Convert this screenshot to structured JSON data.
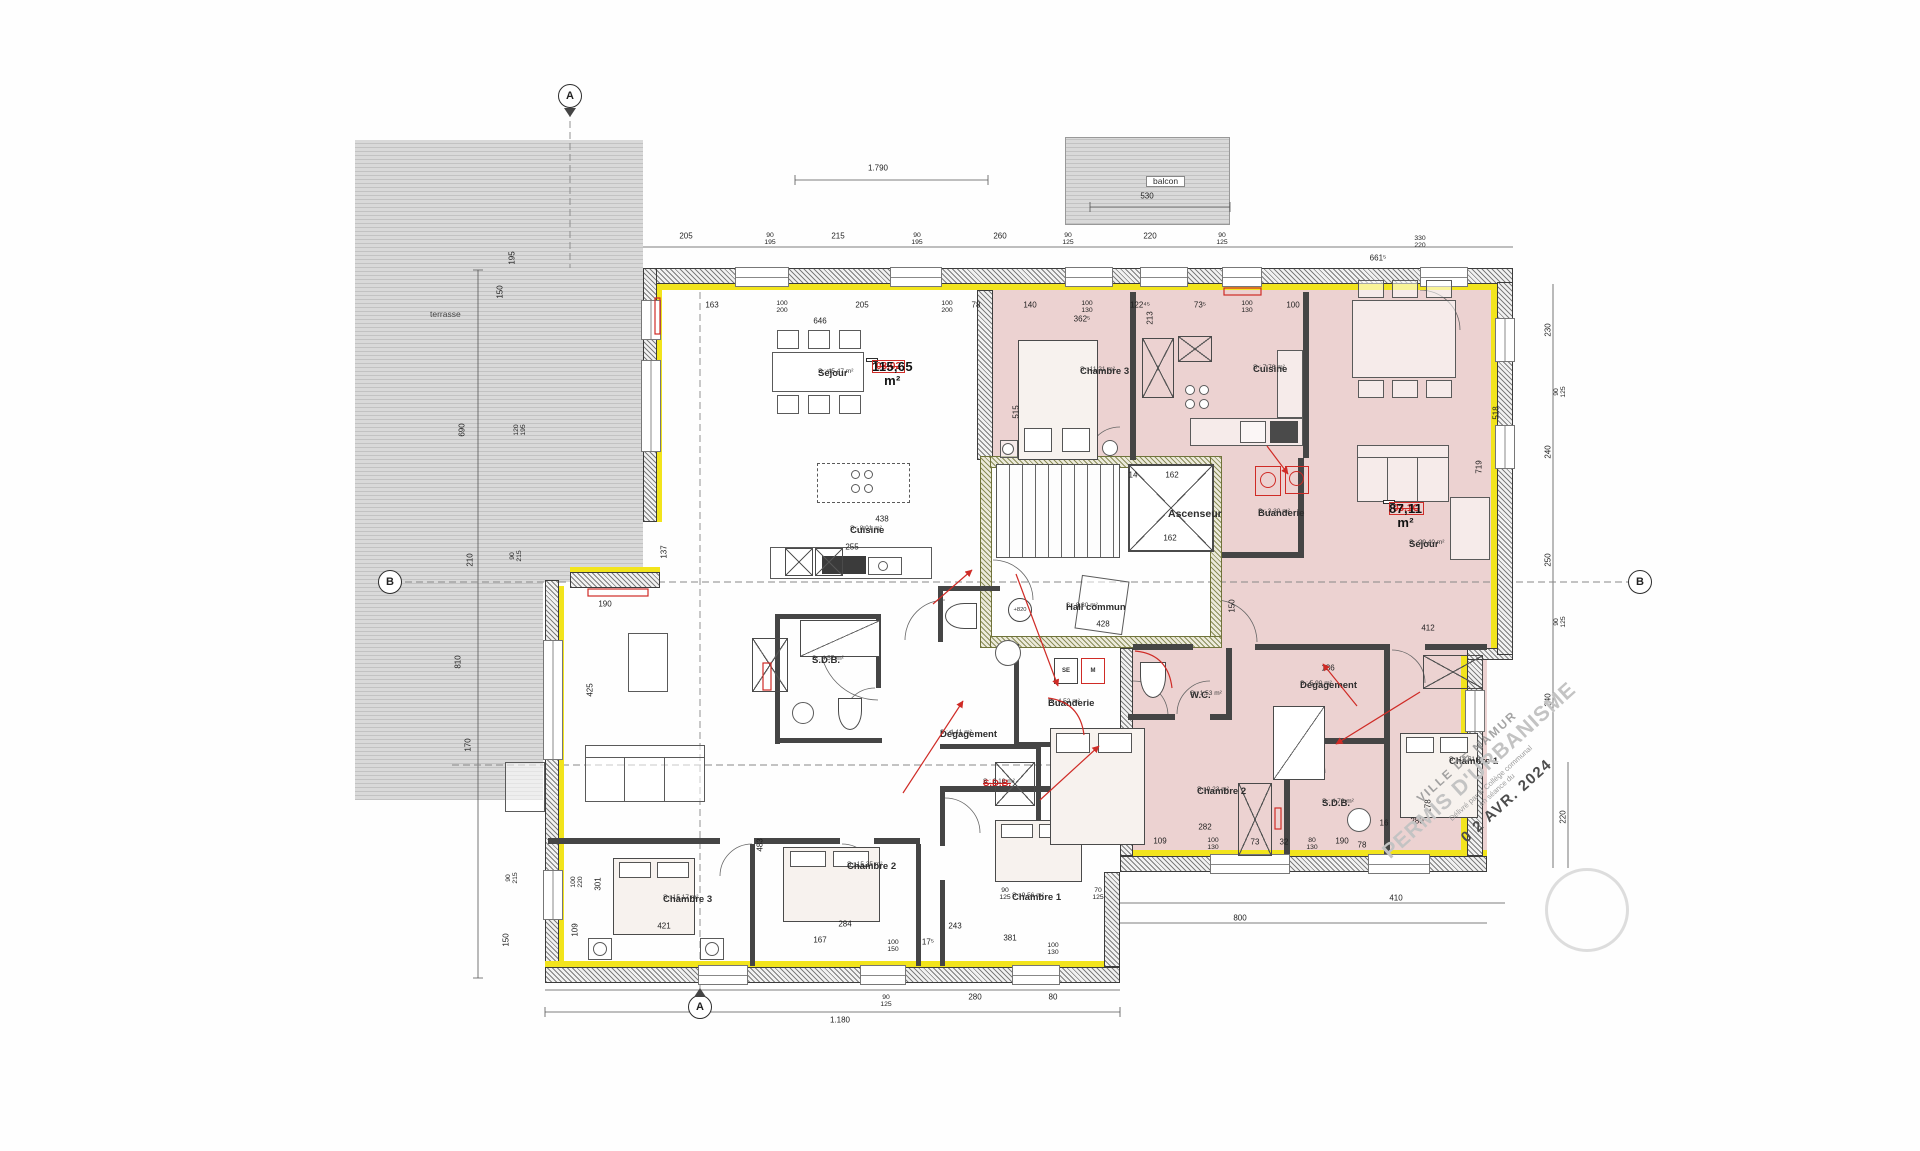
{
  "title": "Plan d'étage - permis d'urbanisme",
  "palette": {
    "pink": "#ecd2d1",
    "insulation_yellow": "#f2e41c",
    "wall_gray": "#7d7d7d",
    "revision_red": "#cf2b26",
    "hatch_gray": "#d9d9d9"
  },
  "outdoor": {
    "terrasse": "terrasse",
    "balcon": "balcon"
  },
  "apartments": {
    "apt_left": {
      "code": "03.02",
      "area": "115,65 m²"
    },
    "apt_right": {
      "code": "03.1C",
      "area": "87,11 m²"
    }
  },
  "core": {
    "ascenseur": "Ascenseur",
    "hall_name": "Hall commun",
    "hall_area": "S : 8,30 m²",
    "level": "+820"
  },
  "laundry": {
    "se": "SE",
    "m": "M"
  },
  "markers": {
    "a": "A",
    "b": "B"
  },
  "stamp": {
    "line1": "VILLE DE NAMUR",
    "line2": "PERMIS D'URBANISME",
    "line3": "Délivré par le Collège communal",
    "line4": "en séance du",
    "date": "0 2 AVR. 2024"
  },
  "rooms": [
    {
      "id": "sejour-blanc",
      "name": "Séjour",
      "area": "S : 45,47 m²",
      "x": 818,
      "y": 369,
      "cls": ""
    },
    {
      "id": "cuisine-blanc",
      "name": "Cuisine",
      "area": "S : 8,01 m²",
      "x": 850,
      "y": 526,
      "cls": ""
    },
    {
      "id": "sdb-blanc",
      "name": "S.D.B.",
      "area": "S : 4,57 m²",
      "x": 812,
      "y": 656,
      "cls": ""
    },
    {
      "id": "degagement-blanc",
      "name": "Dégagement",
      "area": "S : 4,41 m²",
      "x": 940,
      "y": 730,
      "cls": ""
    },
    {
      "id": "buanderie-blanc",
      "name": "Buanderie",
      "area": "S : 4,52 m²",
      "x": 1048,
      "y": 699,
      "cls": ""
    },
    {
      "id": "sdb2-blanc",
      "name": "S.D.B.",
      "area": "S : 3,10 m²",
      "x": 983,
      "y": 779,
      "cls": "struck"
    },
    {
      "id": "chambre3-blanc",
      "name": "Chambre 3",
      "area": "S : 15,17 m²",
      "x": 663,
      "y": 895,
      "cls": ""
    },
    {
      "id": "chambre2-blanc",
      "name": "Chambre 2",
      "area": "S : 15,35 m²",
      "x": 847,
      "y": 862,
      "cls": ""
    },
    {
      "id": "chambre1-blanc",
      "name": "Chambre 1",
      "area": "S : 9,56 m²",
      "x": 1012,
      "y": 893,
      "cls": ""
    },
    {
      "id": "ascenseur",
      "name": "Ascenseur",
      "area": "",
      "x": 1168,
      "y": 509,
      "cls": "big"
    },
    {
      "id": "hall-commun",
      "name": "Hall commun",
      "area": "S : 8,30 m²",
      "x": 1066,
      "y": 603,
      "cls": ""
    },
    {
      "id": "chambre3-rose",
      "name": "Chambre 3",
      "area": "S : 11,21 m²",
      "x": 1080,
      "y": 367,
      "cls": ""
    },
    {
      "id": "cuisine-rose",
      "name": "Cuisine",
      "area": "S : 7,76 m²",
      "x": 1253,
      "y": 365,
      "cls": ""
    },
    {
      "id": "buanderie-rose",
      "name": "Buanderie",
      "area": "S : 3,30 m²",
      "x": 1258,
      "y": 509,
      "cls": ""
    },
    {
      "id": "sejour-rose",
      "name": "Séjour",
      "area": "S : 29,40 m²",
      "x": 1409,
      "y": 540,
      "cls": ""
    },
    {
      "id": "wc-rose",
      "name": "W.C.",
      "area": "S : 1,53 m²",
      "x": 1190,
      "y": 691,
      "cls": ""
    },
    {
      "id": "degagement-rose",
      "name": "Dégagement",
      "area": "S : 5,90 m²",
      "x": 1300,
      "y": 681,
      "cls": ""
    },
    {
      "id": "chambre2-rose",
      "name": "Chambre 2",
      "area": "S : 9,23 m²",
      "x": 1197,
      "y": 787,
      "cls": ""
    },
    {
      "id": "sdb-rose",
      "name": "S.D.B.",
      "area": "S : 4,76 m²",
      "x": 1322,
      "y": 799,
      "cls": ""
    },
    {
      "id": "chambre1-rose",
      "name": "Chambre 1",
      "area": "S : 13,51 m²",
      "x": 1449,
      "y": 757,
      "cls": ""
    },
    {
      "id": "terrasse",
      "name": "terrasse",
      "area": "",
      "x": 430,
      "y": 310,
      "cls": "out"
    },
    {
      "id": "balcon",
      "name": "balcon",
      "area": "",
      "x": 1146,
      "y": 176,
      "cls": "boxed"
    }
  ],
  "dims": [
    {
      "t": "1.790",
      "x": 878,
      "y": 168
    },
    {
      "t": "205",
      "x": 686,
      "y": 236
    },
    {
      "t": "90\n195",
      "x": 770,
      "y": 240,
      "s": 1
    },
    {
      "t": "215",
      "x": 838,
      "y": 236
    },
    {
      "t": "90\n195",
      "x": 917,
      "y": 240,
      "s": 1
    },
    {
      "t": "260",
      "x": 1000,
      "y": 236
    },
    {
      "t": "90\n125",
      "x": 1068,
      "y": 240,
      "s": 1
    },
    {
      "t": "220",
      "x": 1150,
      "y": 236
    },
    {
      "t": "90\n125",
      "x": 1222,
      "y": 240,
      "s": 1
    },
    {
      "t": "530",
      "x": 1147,
      "y": 196
    },
    {
      "t": "330\n220",
      "x": 1420,
      "y": 243,
      "s": 1
    },
    {
      "t": "661⁵",
      "x": 1378,
      "y": 258
    },
    {
      "t": "163",
      "x": 712,
      "y": 305
    },
    {
      "t": "100\n200",
      "x": 782,
      "y": 308,
      "s": 1
    },
    {
      "t": "205",
      "x": 862,
      "y": 305
    },
    {
      "t": "100\n200",
      "x": 947,
      "y": 308,
      "s": 1
    },
    {
      "t": "78",
      "x": 976,
      "y": 305
    },
    {
      "t": "646",
      "x": 820,
      "y": 321
    },
    {
      "t": "140",
      "x": 1030,
      "y": 305
    },
    {
      "t": "100\n130",
      "x": 1087,
      "y": 308,
      "s": 1
    },
    {
      "t": "122⁴⁵",
      "x": 1140,
      "y": 305
    },
    {
      "t": "362⁵",
      "x": 1082,
      "y": 319
    },
    {
      "t": "73⁵",
      "x": 1200,
      "y": 305
    },
    {
      "t": "100\n130",
      "x": 1247,
      "y": 308,
      "s": 1
    },
    {
      "t": "100",
      "x": 1293,
      "y": 305
    },
    {
      "t": "213",
      "x": 1150,
      "y": 318,
      "v": 1
    },
    {
      "t": "515",
      "x": 1016,
      "y": 412,
      "v": 1
    },
    {
      "t": "195",
      "x": 512,
      "y": 258,
      "v": 1
    },
    {
      "t": "150",
      "x": 500,
      "y": 292,
      "v": 1
    },
    {
      "t": "690",
      "x": 462,
      "y": 430,
      "v": 1
    },
    {
      "t": "120\n195",
      "x": 521,
      "y": 430,
      "v": 1,
      "s": 1
    },
    {
      "t": "210",
      "x": 470,
      "y": 560,
      "v": 1
    },
    {
      "t": "90\n215",
      "x": 517,
      "y": 556,
      "v": 1,
      "s": 1
    },
    {
      "t": "810",
      "x": 458,
      "y": 662,
      "v": 1
    },
    {
      "t": "170",
      "x": 468,
      "y": 745,
      "v": 1
    },
    {
      "t": "90\n215",
      "x": 513,
      "y": 878,
      "v": 1,
      "s": 1
    },
    {
      "t": "150",
      "x": 506,
      "y": 940,
      "v": 1
    },
    {
      "t": "230",
      "x": 1548,
      "y": 330,
      "v": 1
    },
    {
      "t": "90\n125",
      "x": 1561,
      "y": 392,
      "v": 1,
      "s": 1
    },
    {
      "t": "240",
      "x": 1548,
      "y": 452,
      "v": 1
    },
    {
      "t": "518",
      "x": 1496,
      "y": 413,
      "v": 1
    },
    {
      "t": "719",
      "x": 1479,
      "y": 467,
      "v": 1
    },
    {
      "t": "250",
      "x": 1548,
      "y": 560,
      "v": 1
    },
    {
      "t": "90\n125",
      "x": 1561,
      "y": 622,
      "v": 1,
      "s": 1
    },
    {
      "t": "240",
      "x": 1548,
      "y": 700,
      "v": 1
    },
    {
      "t": "220",
      "x": 1563,
      "y": 817,
      "v": 1
    },
    {
      "t": "178",
      "x": 1428,
      "y": 806,
      "v": 1
    },
    {
      "t": "137",
      "x": 664,
      "y": 552,
      "v": 1
    },
    {
      "t": "190",
      "x": 605,
      "y": 604
    },
    {
      "t": "425",
      "x": 590,
      "y": 690,
      "v": 1
    },
    {
      "t": "438",
      "x": 882,
      "y": 519
    },
    {
      "t": "255",
      "x": 852,
      "y": 547
    },
    {
      "t": "14",
      "x": 1133,
      "y": 475
    },
    {
      "t": "162",
      "x": 1172,
      "y": 475
    },
    {
      "t": "162",
      "x": 1170,
      "y": 538
    },
    {
      "t": "428",
      "x": 1103,
      "y": 624
    },
    {
      "t": "412",
      "x": 1428,
      "y": 628
    },
    {
      "t": "150",
      "x": 1232,
      "y": 606,
      "v": 1
    },
    {
      "t": "136",
      "x": 1328,
      "y": 668
    },
    {
      "t": "100\n220",
      "x": 578,
      "y": 882,
      "v": 1,
      "s": 1
    },
    {
      "t": "301",
      "x": 598,
      "y": 884,
      "v": 1
    },
    {
      "t": "109",
      "x": 575,
      "y": 930,
      "v": 1
    },
    {
      "t": "483",
      "x": 760,
      "y": 845,
      "v": 1
    },
    {
      "t": "421",
      "x": 664,
      "y": 926
    },
    {
      "t": "284",
      "x": 845,
      "y": 924
    },
    {
      "t": "167",
      "x": 820,
      "y": 940
    },
    {
      "t": "100\n150",
      "x": 893,
      "y": 947,
      "s": 1
    },
    {
      "t": "17⁵",
      "x": 928,
      "y": 942
    },
    {
      "t": "243",
      "x": 955,
      "y": 926
    },
    {
      "t": "381",
      "x": 1010,
      "y": 938
    },
    {
      "t": "100\n130",
      "x": 1053,
      "y": 950,
      "s": 1
    },
    {
      "t": "109",
      "x": 1160,
      "y": 841
    },
    {
      "t": "282",
      "x": 1205,
      "y": 827
    },
    {
      "t": "100\n130",
      "x": 1213,
      "y": 845,
      "s": 1
    },
    {
      "t": "73",
      "x": 1255,
      "y": 842
    },
    {
      "t": "32",
      "x": 1284,
      "y": 842
    },
    {
      "t": "80\n130",
      "x": 1312,
      "y": 845,
      "s": 1
    },
    {
      "t": "190",
      "x": 1342,
      "y": 841
    },
    {
      "t": "78",
      "x": 1362,
      "y": 845
    },
    {
      "t": "16",
      "x": 1384,
      "y": 823
    },
    {
      "t": "280",
      "x": 1417,
      "y": 821
    },
    {
      "t": "90\n125",
      "x": 886,
      "y": 1002,
      "s": 1
    },
    {
      "t": "280",
      "x": 975,
      "y": 997
    },
    {
      "t": "80",
      "x": 1053,
      "y": 997
    },
    {
      "t": "1.180",
      "x": 840,
      "y": 1020
    },
    {
      "t": "90\n125",
      "x": 1005,
      "y": 895,
      "s": 1
    },
    {
      "t": "70\n125",
      "x": 1098,
      "y": 895,
      "s": 1
    },
    {
      "t": "410",
      "x": 1396,
      "y": 898
    },
    {
      "t": "800",
      "x": 1240,
      "y": 918
    }
  ]
}
